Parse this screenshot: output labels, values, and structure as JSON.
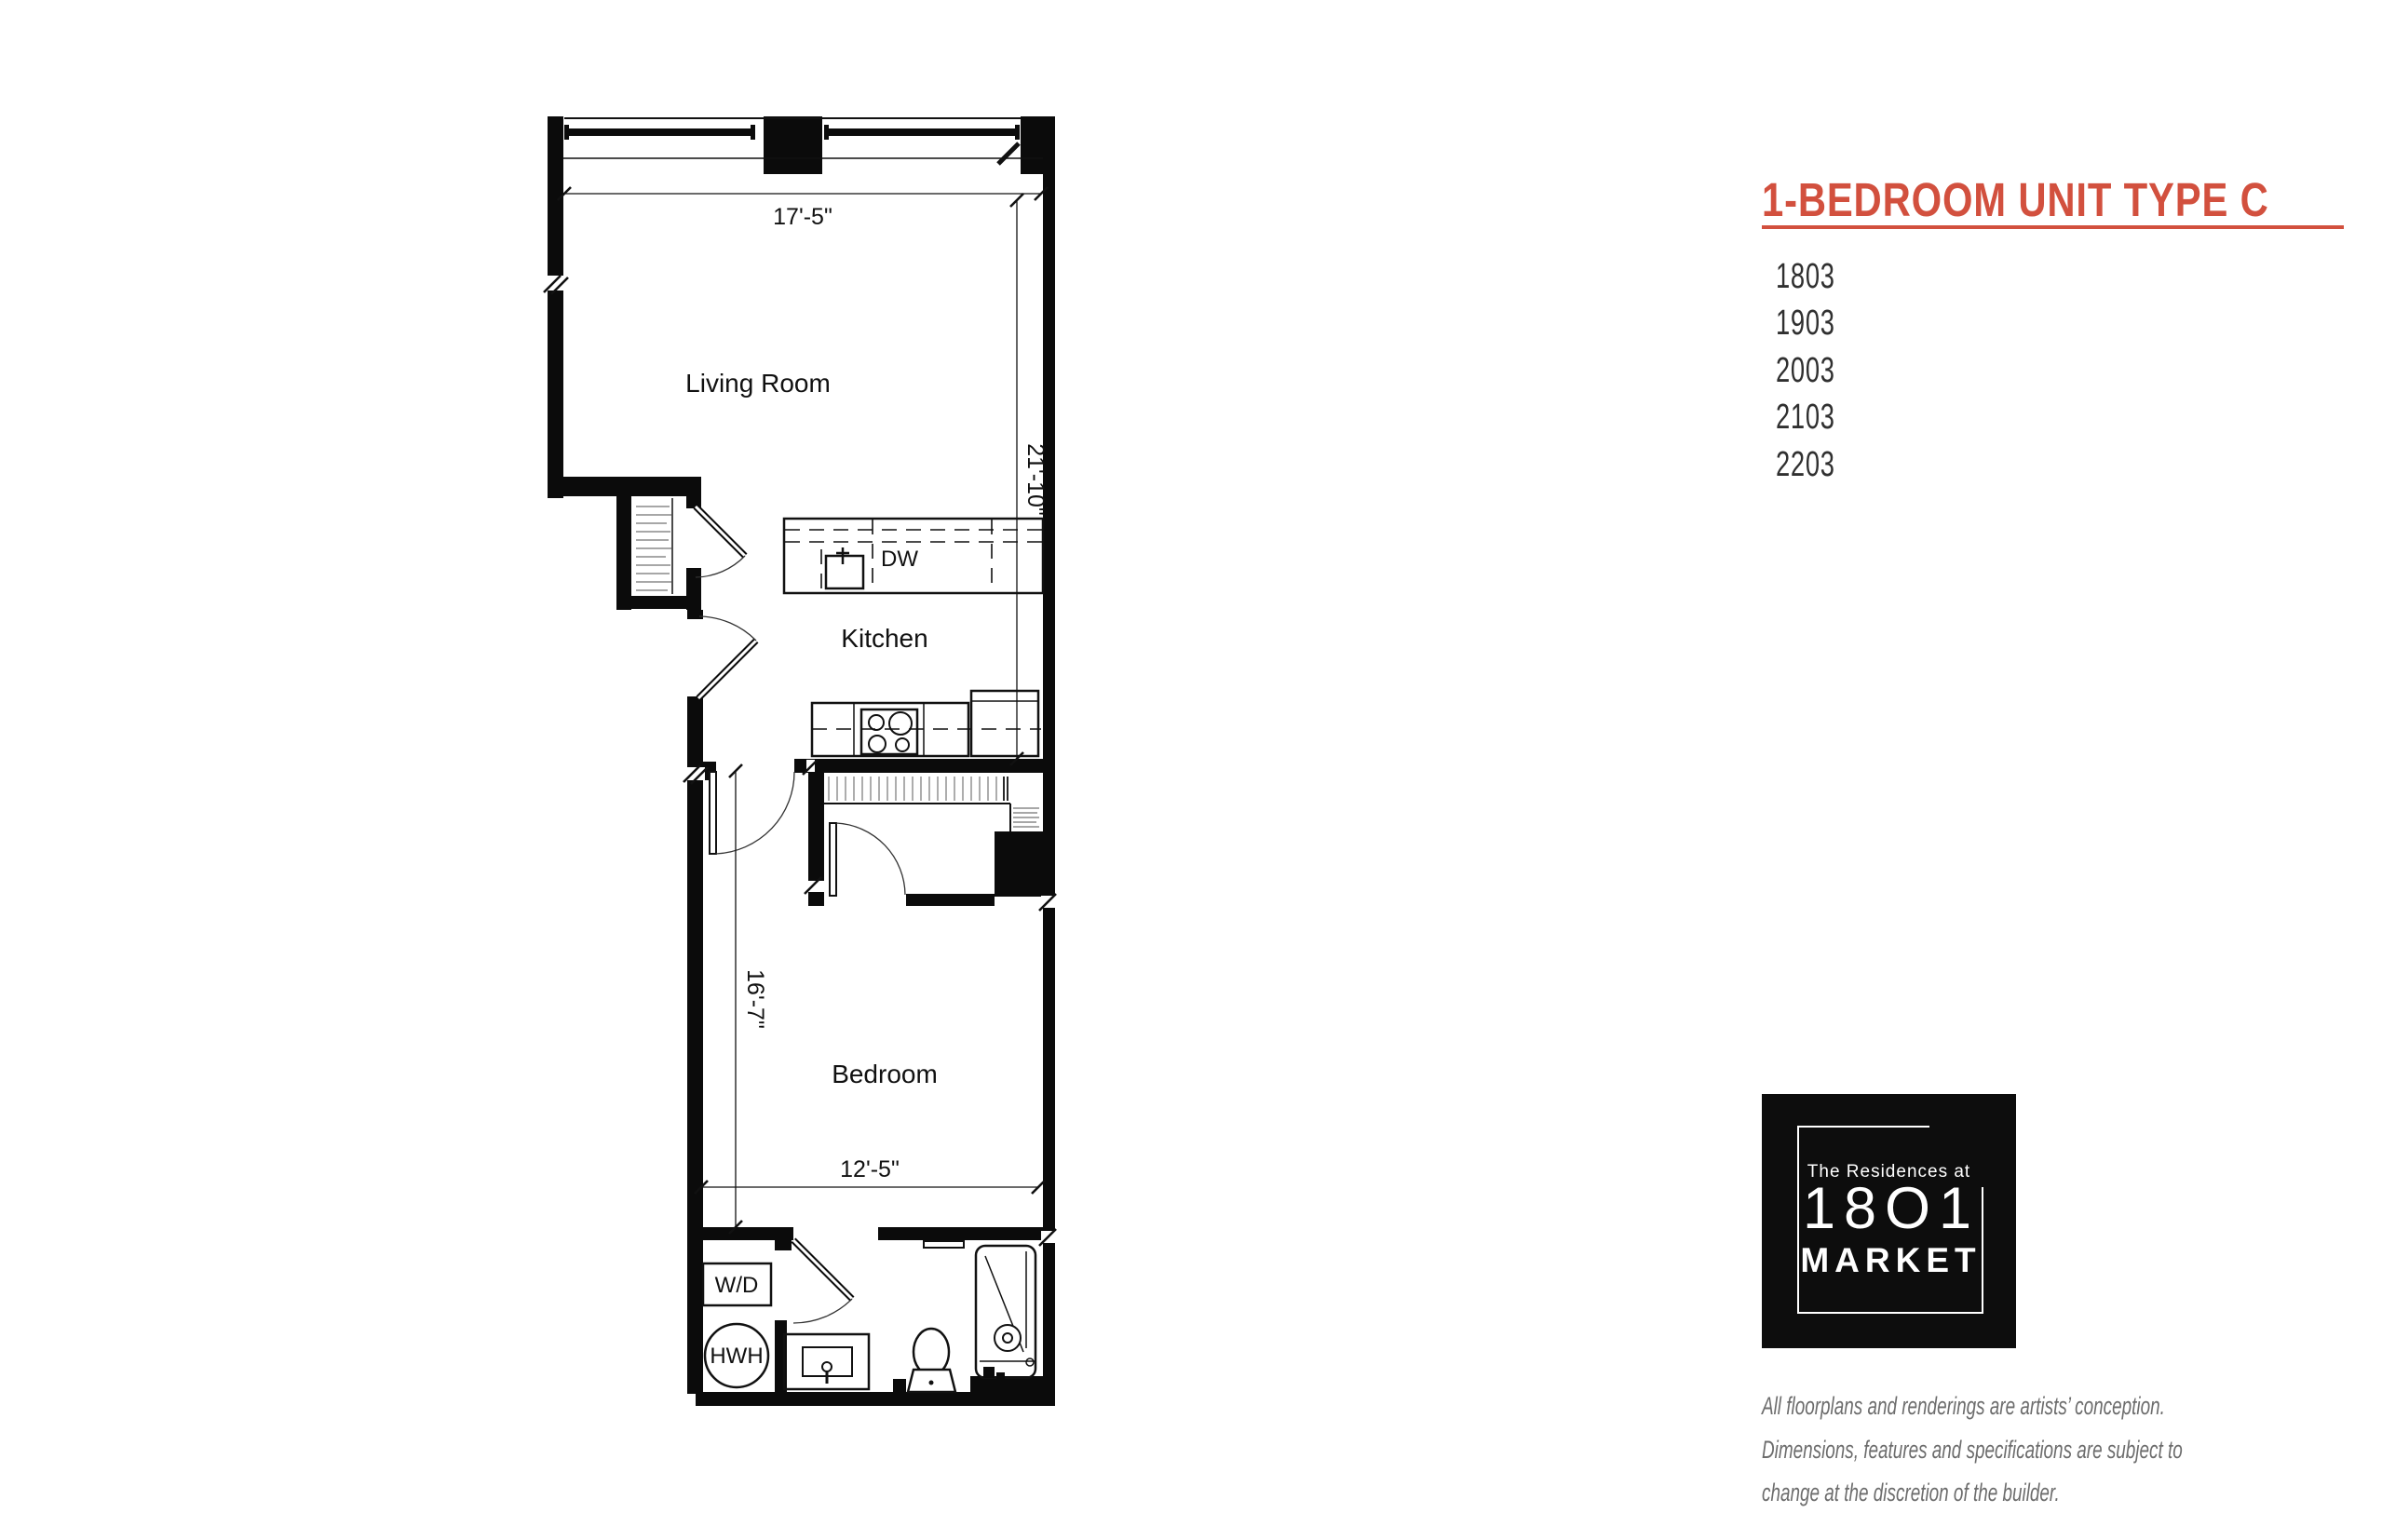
{
  "floorplan": {
    "rooms": {
      "living_room": "Living Room",
      "kitchen": "Kitchen",
      "bedroom": "Bedroom"
    },
    "appliances": {
      "dishwasher": "DW",
      "washer_dryer": "W/D",
      "hot_water_heater": "HWH"
    },
    "dimensions": {
      "living_width": "17'-5\"",
      "living_length": "21'-10\"",
      "bedroom_length": "16'-7\"",
      "bedroom_width": "12'-5\""
    }
  },
  "panel": {
    "title": "1-BEDROOM UNIT TYPE C",
    "accent_color": "#D2503E",
    "units": [
      "1803",
      "1903",
      "2003",
      "2103",
      "2203"
    ]
  },
  "logo": {
    "line1": "The Residences at",
    "line2": "18O1",
    "line3": "MARKET"
  },
  "disclaimer": {
    "lines": [
      "All floorplans and renderings are artists’ conception.",
      "Dimensions, features and specifications are subject to",
      "change at the discretion of the builder."
    ]
  }
}
